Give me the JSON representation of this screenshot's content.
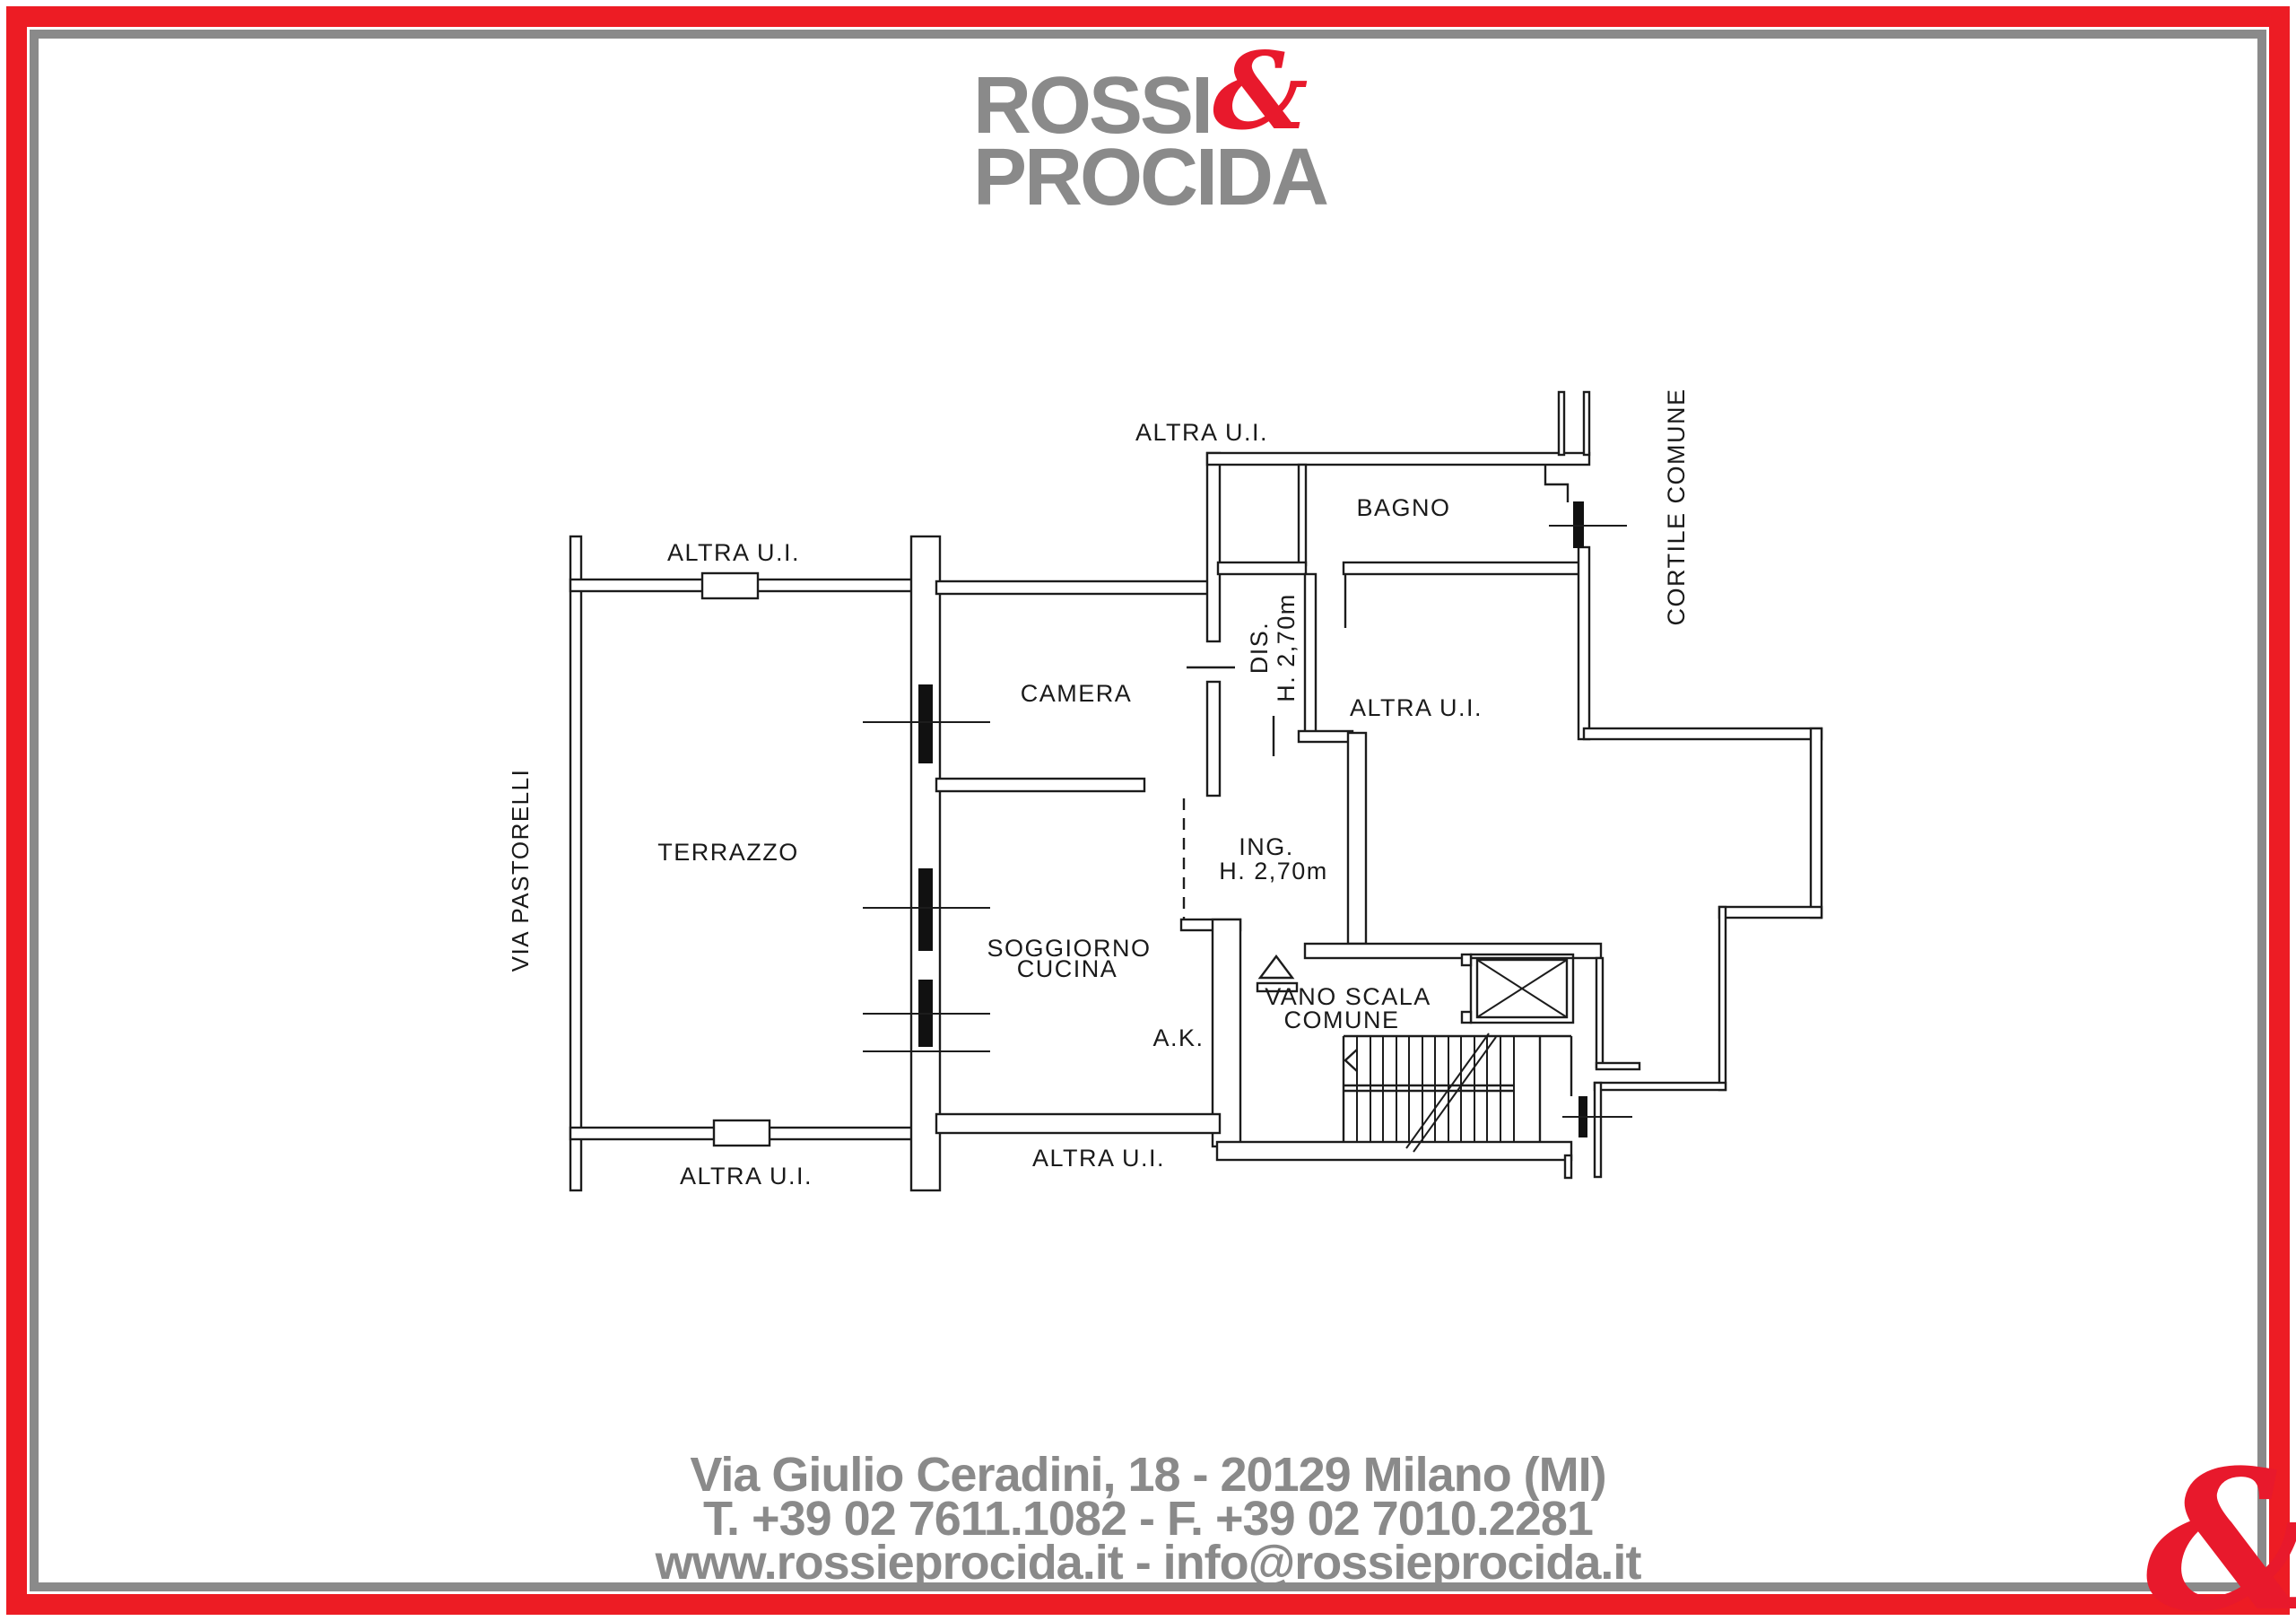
{
  "logo": {
    "line1": "ROSSI",
    "ampersand": "&",
    "line2": "PROCIDA"
  },
  "plan": {
    "labels": {
      "altra_ui": "ALTRA U.I.",
      "terrazzo": "TERRAZZO",
      "camera": "CAMERA",
      "bagno": "BAGNO",
      "soggiorno_line1": "SOGGIORNO",
      "soggiorno_line2": "CUCINA",
      "dis": "DIS.",
      "dis_height": "H. 2,70m",
      "ing": "ING.",
      "ing_height": "H. 2,70m",
      "ak": "A.K.",
      "vano_scala_line1": "VANO SCALA",
      "vano_scala_line2": "COMUNE",
      "via_pastorelli": "VIA PASTORELLI",
      "cortile_comune": "CORTILE COMUNE"
    }
  },
  "footer": {
    "address": "Via Giulio Ceradini, 18 - 20129 Milano (MI)",
    "phones": "T. +39 02 7611.1082 - F. +39 02 7010.2281",
    "web": "www.rossieprocida.it - info@rossieprocida.it"
  },
  "corner_ampersand": "&",
  "colors": {
    "brand_red": "#ed1c24",
    "brand_gray": "#8a8a8a",
    "line": "#1c1c1c"
  }
}
